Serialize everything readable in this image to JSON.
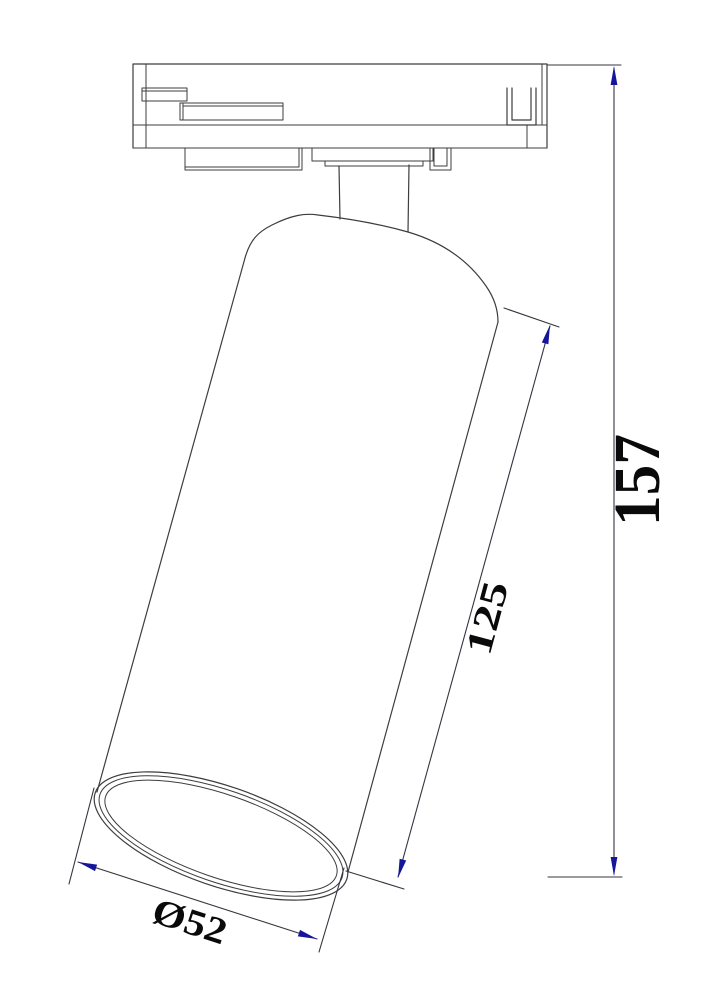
{
  "dimensions": {
    "height": "157",
    "body_length": "125",
    "diameter": "Ø52"
  },
  "colors": {
    "background": "#ffffff",
    "geometry_line": "#3d3d3d",
    "dimension_line": "#35353f",
    "arrow": "#16169b",
    "text": "#0a0a0a"
  }
}
